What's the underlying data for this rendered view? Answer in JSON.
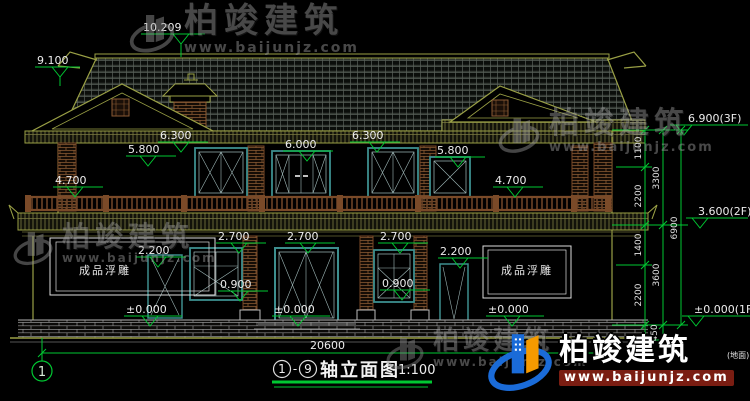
{
  "watermark": {
    "brand": "柏竣建筑",
    "url": "www.baijunjz.com"
  },
  "title_block": {
    "axis_start": "1",
    "axis_end": "9",
    "separator": "-",
    "name": "轴立面图",
    "scale": "1:100"
  },
  "drawing": {
    "axis_bubble": "1",
    "ground_note": "(地面)",
    "panels": {
      "left": "成品浮雕",
      "right": "成品浮雕"
    },
    "labels": [
      {
        "t": "10.209",
        "x": 143,
        "y": 31
      },
      {
        "t": "9.100",
        "x": 37,
        "y": 64
      },
      {
        "t": "6.300",
        "x": 160,
        "y": 139
      },
      {
        "t": "5.800",
        "x": 128,
        "y": 153
      },
      {
        "t": "6.000",
        "x": 285,
        "y": 148
      },
      {
        "t": "6.300",
        "x": 352,
        "y": 139
      },
      {
        "t": "5.800",
        "x": 437,
        "y": 154
      },
      {
        "t": "4.700",
        "x": 55,
        "y": 184
      },
      {
        "t": "4.700",
        "x": 495,
        "y": 184
      },
      {
        "t": "2.700",
        "x": 218,
        "y": 240
      },
      {
        "t": "2.700",
        "x": 287,
        "y": 240
      },
      {
        "t": "2.700",
        "x": 380,
        "y": 240
      },
      {
        "t": "2.200",
        "x": 138,
        "y": 254
      },
      {
        "t": "2.200",
        "x": 440,
        "y": 255
      },
      {
        "t": "0.900",
        "x": 220,
        "y": 288
      },
      {
        "t": "0.900",
        "x": 382,
        "y": 287
      },
      {
        "t": "±0.000",
        "x": 126,
        "y": 313
      },
      {
        "t": "±0.000",
        "x": 274,
        "y": 313
      },
      {
        "t": "±0.000",
        "x": 488,
        "y": 313
      },
      {
        "t": "6.900(3F)",
        "x": 688,
        "y": 122
      },
      {
        "t": "3.600(2F)",
        "x": 698,
        "y": 215
      },
      {
        "t": "±0.000(1F)",
        "x": 694,
        "y": 313
      },
      {
        "t": "20600",
        "x": 310,
        "y": 349
      },
      {
        "t": "1100",
        "x": 641,
        "y": 148,
        "r": -90,
        "s": "ch"
      },
      {
        "t": "2200",
        "x": 641,
        "y": 196,
        "r": -90,
        "s": "ch"
      },
      {
        "t": "1400",
        "x": 641,
        "y": 245,
        "r": -90,
        "s": "ch"
      },
      {
        "t": "2200",
        "x": 641,
        "y": 295,
        "r": -90,
        "s": "ch"
      },
      {
        "t": "450",
        "x": 657,
        "y": 333,
        "r": -90,
        "s": "ch"
      },
      {
        "t": "3300",
        "x": 659,
        "y": 178,
        "r": -90,
        "s": "ch"
      },
      {
        "t": "3600",
        "x": 659,
        "y": 275,
        "r": -90,
        "s": "ch"
      },
      {
        "t": "6900",
        "x": 677,
        "y": 228,
        "r": -90,
        "s": "ch"
      }
    ]
  },
  "colors": {
    "background": "#000000",
    "dimension_green": "#00c832",
    "outline_olive": "#9aa045",
    "window_teal": "#3d8e8e",
    "brick_brown": "#8a5a33",
    "text_white": "#ececec",
    "logo_blue": "#1a6bd8",
    "logo_orange": "#f59a00",
    "logo_url_bar": "#7a1d12"
  }
}
